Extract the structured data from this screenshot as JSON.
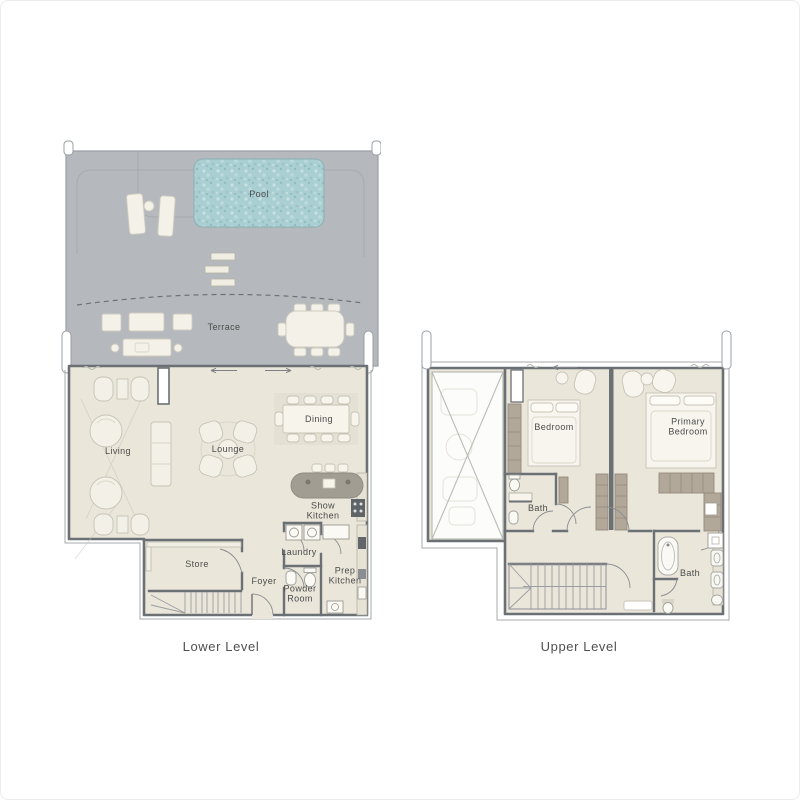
{
  "colors": {
    "background": "#ffffff",
    "terrace_gray": "#b5b8bd",
    "pool_water": "#aacfd2",
    "interior_floor": "#eae6da",
    "wall": "#6b7074",
    "furniture": "#f7f4ec",
    "wardrobe": "#b2a89a",
    "kitchen_island": "#a19d93",
    "appliance_dark": "#5f6468",
    "label_text": "#4b4b4b"
  },
  "lower_level": {
    "caption": "Lower Level",
    "labels": {
      "pool": "Pool",
      "terrace": "Terrace",
      "living": "Living",
      "lounge": "Lounge",
      "dining": "Dining",
      "show_kitchen": "Show Kitchen",
      "store": "Store",
      "foyer": "Foyer",
      "laundry": "Laundry",
      "powder_room": "Powder Room",
      "prep_kitchen": "Prep Kitchen"
    }
  },
  "upper_level": {
    "caption": "Upper Level",
    "labels": {
      "bedroom": "Bedroom",
      "primary_bedroom": "Primary Bedroom",
      "bath_1": "Bath",
      "bath_2": "Bath"
    }
  }
}
